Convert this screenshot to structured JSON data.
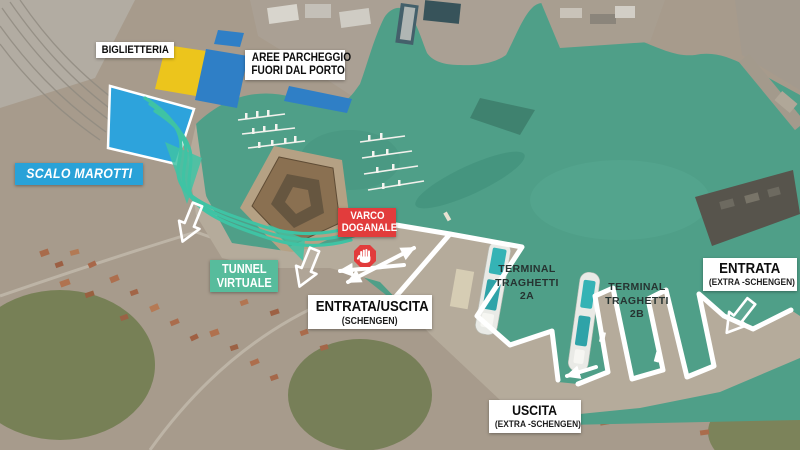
{
  "colors": {
    "water": "#4f9f88",
    "quay": "#b5ab9b",
    "route_teal": "#3fc3a4",
    "area_blue": "#2da3dc",
    "parking_blue": "#2f7fc6",
    "parking_yellow": "#ecc51c",
    "scalo_marotti_bg": "#29a2d8",
    "tunnel_bg": "#57bc9c",
    "varco_bg": "#e23c3c",
    "label_bg": "#ffffff",
    "path_white": "#ffffff"
  },
  "labels": {
    "biglietteria": {
      "text": "BIGLIETTERIA"
    },
    "aree_parcheggio": {
      "line1": "AREE PARCHEGGIO",
      "line2": "FUORI DAL PORTO"
    },
    "scalo_marotti": {
      "text": "SCALO MAROTTI"
    },
    "tunnel_virtuale": {
      "line1": "TUNNEL",
      "line2": "VIRTUALE"
    },
    "varco_doganale": {
      "line1": "VARCO",
      "line2": "DOGANALE"
    },
    "entrata_uscita_schengen": {
      "line1": "ENTRATA/USCITA",
      "line2": "(SCHENGEN)"
    },
    "terminal_2a": {
      "line1": "TERMINAL",
      "line2": "TRAGHETTI",
      "line3": "2A"
    },
    "terminal_2b": {
      "line1": "TERMINAL",
      "line2": "TRAGHETTI",
      "line3": "2B"
    },
    "entrata_extra": {
      "line1": "ENTRATA",
      "line2": "(EXTRA -SCHENGEN)"
    },
    "uscita_extra": {
      "line1": "USCITA",
      "line2": "(EXTRA -SCHENGEN)"
    }
  },
  "icons": {
    "stop_hand": "stop-hand"
  }
}
